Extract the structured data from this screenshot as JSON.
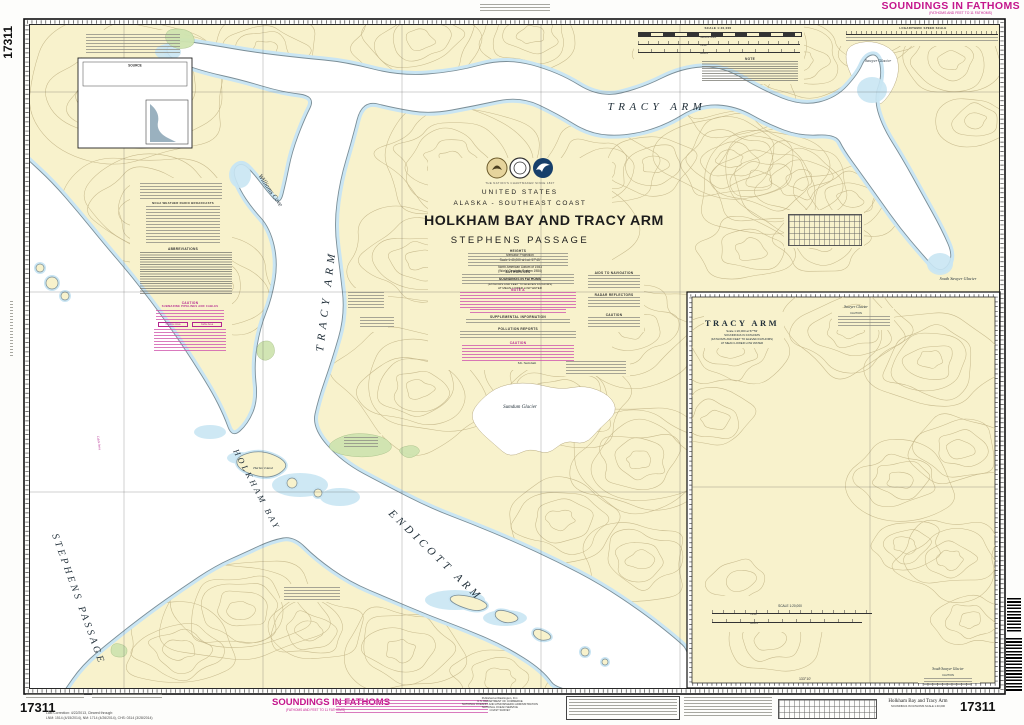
{
  "chart_number": "17311",
  "margin": {
    "soundings_top": "SOUNDINGS IN FATHOMS",
    "soundings_top_sub": "(FATHOMS AND FEET TO 11 FATHOMS)",
    "soundings_bottom": "SOUNDINGS IN FATHOMS",
    "soundings_bottom_sub": "(FATHOMS AND FEET TO 11 FATHOMS)",
    "publisher_1": "Published at Washington, D.C.",
    "publisher_2": "U.S. DEPARTMENT OF COMMERCE",
    "publisher_3": "NATIONAL OCEANIC AND ATMOSPHERIC ADMINISTRATION",
    "publisher_4": "NATIONAL OCEAN SERVICE",
    "publisher_5": "COAST SURVEY",
    "corrections_1": "Last Correction: 4/22/2013, Cleared through:",
    "corrections_2": "LNM: 1514 (4/15/2014), NM: 1714 (4/26/2014), CHS: 0314 (3/28/2014)",
    "br_title": "Holkham Bay and Tracy Arm",
    "br_sub": "SOUNDINGS IN FATHOMS      SCALE 1:40,000"
  },
  "title_block": {
    "tagline": "THE NATION'S CHARTMAKER SINCE 1807",
    "country": "UNITED STATES",
    "region": "ALASKA - SOUTHEAST COAST",
    "title": "HOLKHAM BAY AND TRACY ARM",
    "subtitle": "STEPHENS PASSAGE",
    "projection": "Mercator Projection",
    "scale": "Scale 1:40,000 at Lat. 57°45'",
    "datum1": "North American Datum of 1983",
    "datum2": "(World Geodetic System 1984)",
    "sound1": "SOUNDINGS IN FATHOMS",
    "sound2": "(FATHOMS AND FEET TO ELEVEN FATHOMS)",
    "sound3": "AT MEAN LOWER LOW WATER"
  },
  "headers": {
    "heights": "HEIGHTS",
    "authorities": "AUTHORITIES",
    "note_a": "NOTE A",
    "supplemental": "SUPPLEMENTAL INFORMATION",
    "pollution": "POLLUTION REPORTS",
    "caution": "CAUTION",
    "aids": "AIDS TO NAVIGATION",
    "radar": "RADAR REFLECTORS",
    "weather": "NOAA WEATHER RADIO BROADCASTS",
    "abbrev": "ABBREVIATIONS",
    "note": "NOTE",
    "source": "SOURCE",
    "pipelines_caution": "SUBMARINE PIPELINES AND CABLES",
    "pipeline_area": "Pipeline Area",
    "cable_area": "Cable Area"
  },
  "labels": {
    "tracy_top": "TRACY ARM",
    "tracy_vert": "TRACY ARM",
    "williams": "Williams Cove",
    "holkham": "HOLKHAM BAY",
    "endicott": "ENDICOTT ARM",
    "stephens": "STEPHENS PASSAGE",
    "sumdum": "Sumdum Glacier",
    "mt_sumdum": "Mt. Sumdum",
    "sawyer": "Sawyer Glacier",
    "south_sawyer": "South Sawyer Glacier",
    "harbor": "Harbor Island",
    "cable_line": "Cable Area"
  },
  "scalebars": {
    "main": "SCALE 1:40,000",
    "nm": "Nautical Miles",
    "yards": "Yards",
    "meters": "Meters",
    "log": "LOGARITHMIC SPEED SCALE",
    "inset": "SCALE 1:20,000"
  },
  "inset": {
    "title": "TRACY ARM",
    "sub1": "Scale 1:20,000 at 57°53'",
    "sub2": "SOUNDINGS IN FATHOMS",
    "sub3": "(FATHOMS AND FEET TO ELEVEN FATHOMS)",
    "sub4": "AT MEAN LOWER LOW WATER",
    "sawyer": "Sawyer Glacier",
    "south_sawyer": "South Sawyer Glacier",
    "caution": "CAUTION"
  },
  "graticule": {
    "top": [
      "50'",
      "45'",
      "133°40'",
      "35'"
    ],
    "bottom": [
      "50'",
      "45'",
      "133°40'",
      "35'",
      "30'",
      "25'"
    ],
    "left": [
      "57°55'",
      "50'",
      "45'"
    ],
    "inset_lon": "133°10'"
  },
  "source_rows": [
    "A",
    "B",
    "C",
    "D"
  ],
  "colors": {
    "magenta": "#c4168c",
    "rose": "#d06cb4",
    "land": "#f8f2cc",
    "shallow": "#c9e5f3",
    "green": "#cfe4b0",
    "contour": "#c6b88b",
    "shore": "#7b8e97"
  }
}
